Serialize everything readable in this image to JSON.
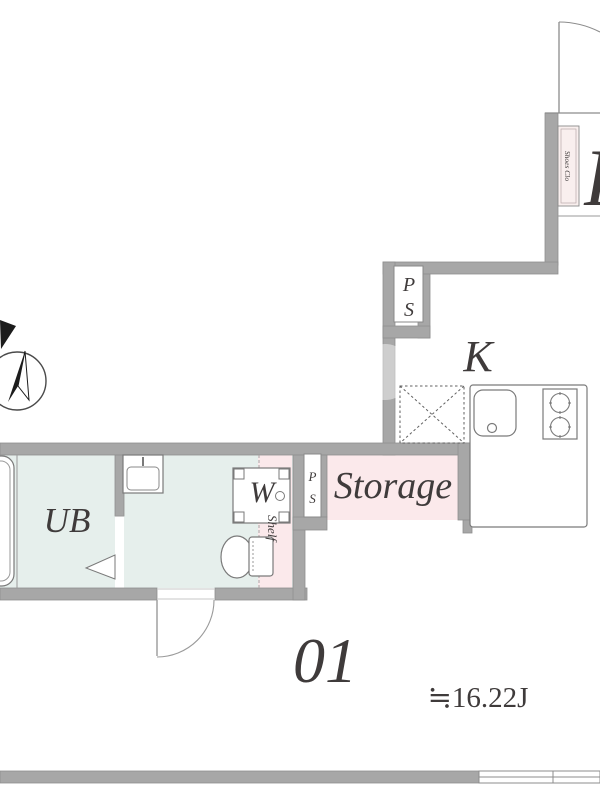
{
  "plan": {
    "labels": {
      "kitchen": "K",
      "unit_bath": "UB",
      "washer": "W",
      "shelf": "Shelf",
      "storage": "Storage",
      "shoes_closet": "Shoes Clo",
      "pipe_shaft_p": "P",
      "pipe_shaft_s": "S",
      "unit_number": "01",
      "area": "≒16.22J",
      "partial_room_letter": "R"
    },
    "colors": {
      "wall_gray": "#a7a7a7",
      "bath_tint": "#e6efec",
      "closet_pink": "#fbe9eb",
      "line_gray": "#8c8c8c",
      "text_dark": "#3f3b3b"
    }
  }
}
